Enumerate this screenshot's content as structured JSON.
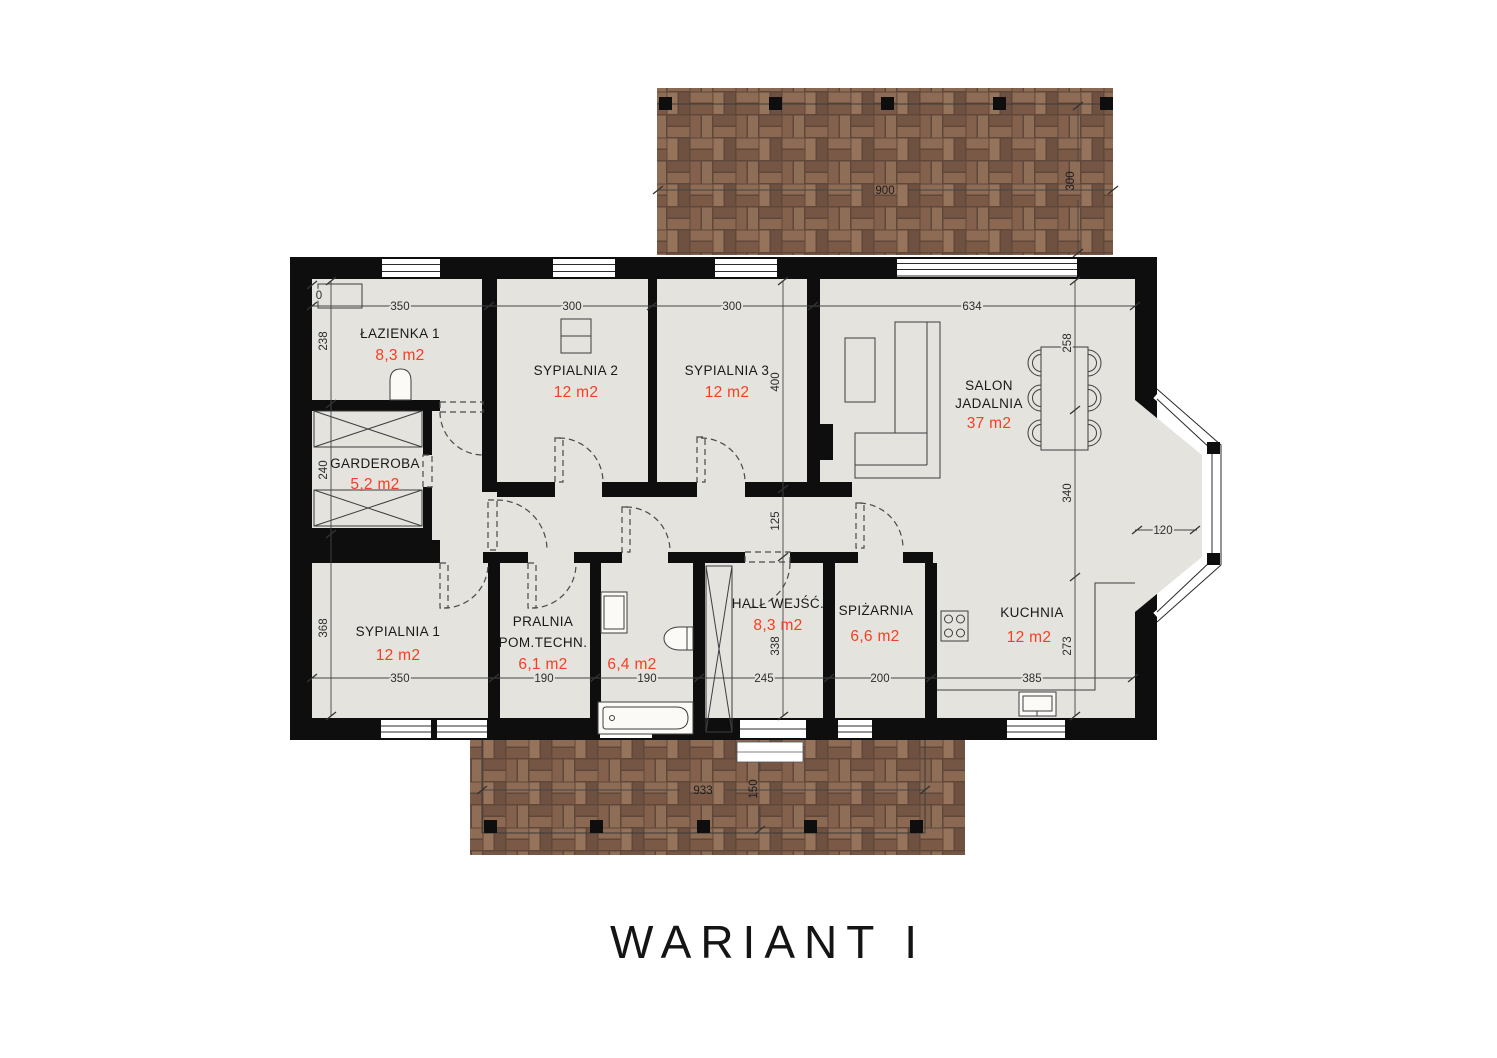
{
  "title": "WARIANT  I",
  "colors": {
    "wall": "#0e0e0e",
    "floor": "#e4e3de",
    "area_text": "#f93d20",
    "terrace_brick": "#7e5f4c"
  },
  "rooms": {
    "lazienka1": {
      "name": "ŁAZIENKA 1",
      "area": "8,3 m2"
    },
    "sypialnia2": {
      "name": "SYPIALNIA 2",
      "area": "12 m2"
    },
    "sypialnia3": {
      "name": "SYPIALNIA 3",
      "area": "12 m2"
    },
    "salon": {
      "name_line1": "SALON",
      "name_line2": "JADALNIA",
      "area": "37 m2"
    },
    "garderoba": {
      "name": "GARDEROBA",
      "area": "5,2 m2"
    },
    "sypialnia1": {
      "name": "SYPIALNIA 1",
      "area": "12 m2"
    },
    "pralnia": {
      "name_line1": "PRALNIA",
      "name_line2": "POM.TECHN.",
      "area": "6,1 m2"
    },
    "lazienka2": {
      "area": "6,4 m2"
    },
    "hall": {
      "name": "HALL WEJŚĆ.",
      "area": "8,3 m2"
    },
    "spizarnia": {
      "name": "SPIŻARNIA",
      "area": "6,6 m2"
    },
    "kuchnia": {
      "name": "KUCHNIA",
      "area": "12 m2"
    }
  },
  "dims": {
    "top": [
      "350",
      "300",
      "300",
      "634"
    ],
    "bottom": [
      "350",
      "190",
      "190",
      "245",
      "200",
      "385"
    ],
    "left": [
      "238",
      "240",
      "368"
    ],
    "middle": [
      "400",
      "125",
      "338"
    ],
    "right": [
      "258",
      "340",
      "273"
    ],
    "bay": "120",
    "origin": "0",
    "terrace_top": {
      "width": "900",
      "depth": "300"
    },
    "terrace_bottom": {
      "width": "933",
      "depth": "150"
    }
  }
}
